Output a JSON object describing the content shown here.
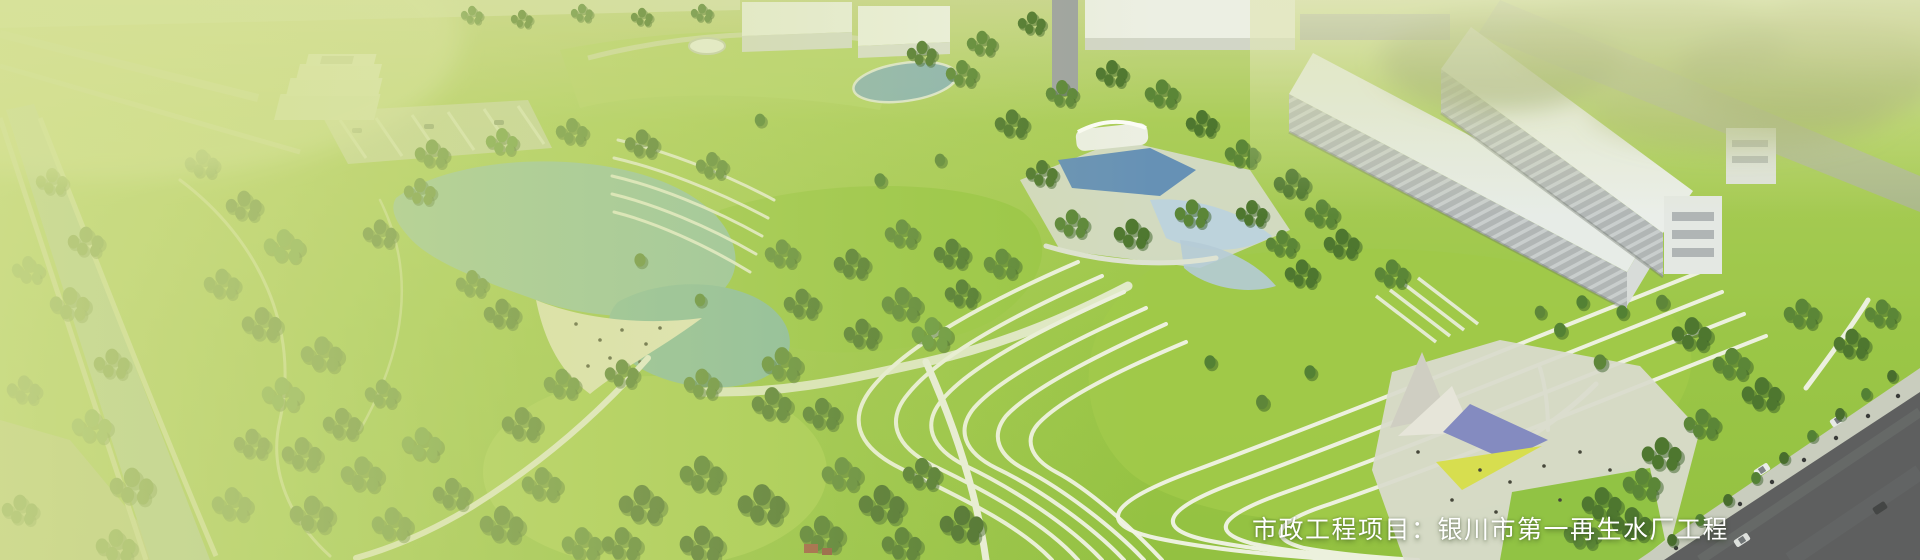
{
  "caption": {
    "text": "市政工程项目：银川市第一再生水厂工程"
  },
  "scene": {
    "description": "aerial 3D rendering of a reclaimed-water-plant park with lake, terraced lawns, treatment pools, white plant buildings and entrance plaza",
    "palette": {
      "overlay_green": "#d3df8e",
      "lawn_green": "#9ac83f",
      "tree_dark_green": "#446f28",
      "lake_teal": "#8fc0a6",
      "pool_blue": "#5e8bb9",
      "building_white": "#eceff0",
      "building_face_gray": "#b2b6bc",
      "road_dark": "#55565c",
      "path_white": "#f2f4ee",
      "canopy_purple": "#7e85c4",
      "canopy_yellow": "#d8de4b",
      "caption_color": "#ffffff"
    }
  }
}
